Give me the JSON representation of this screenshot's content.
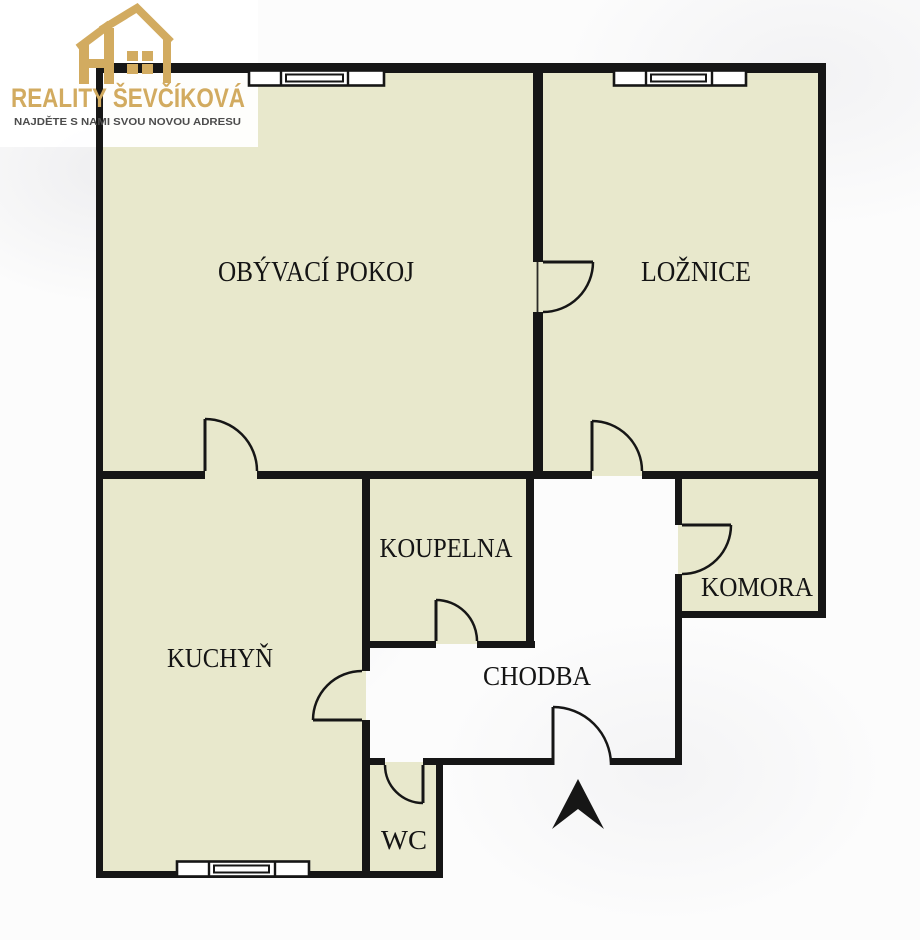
{
  "logo": {
    "title": "REALITY ŠEVČÍKOVÁ",
    "tagline": "NAJDĚTE S NAMI SVOU NOVOU ADRESU",
    "icon": "house-logo-icon"
  },
  "rooms": [
    {
      "id": "obyvaci-pokoj",
      "label": "OBÝVACÍ POKOJ"
    },
    {
      "id": "loznice",
      "label": "LOŽNICE"
    },
    {
      "id": "koupelna",
      "label": "KOUPELNA"
    },
    {
      "id": "komora",
      "label": "KOMORA"
    },
    {
      "id": "kuchyn",
      "label": "KUCHYŇ"
    },
    {
      "id": "chodba",
      "label": "CHODBA"
    },
    {
      "id": "wc",
      "label": "WC"
    }
  ],
  "icons": {
    "north_arrow": "north-arrow-icon"
  },
  "colors": {
    "room-fill": "#e8e8cc",
    "wall": "#161616",
    "logo-gold": "#d2ab60",
    "tagline-text": "#4c4c4c",
    "label-text": "#141414",
    "background": "#fcfcfc"
  }
}
